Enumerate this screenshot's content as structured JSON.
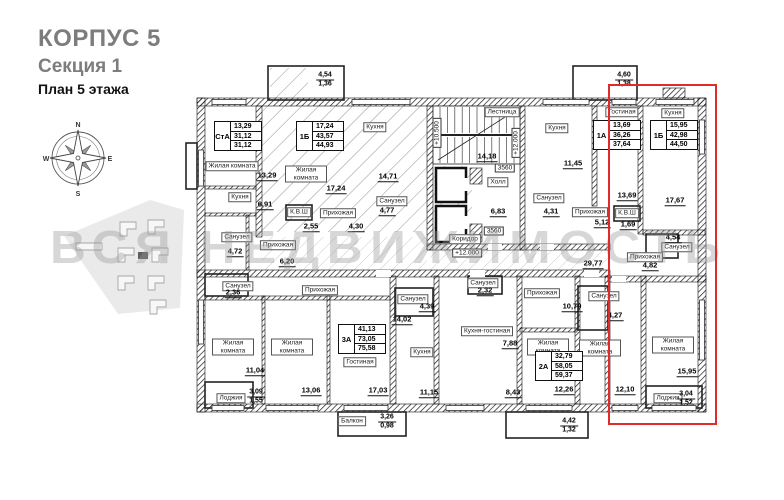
{
  "header": {
    "building": "КОРПУС 5",
    "section": "Секция 1",
    "floor_plan": "План 5 этажа"
  },
  "compass": {
    "north": "N",
    "east": "E",
    "south": "S",
    "west": "W"
  },
  "watermark": {
    "text": "ВСЯ НЕДВИЖИМОСТЬ"
  },
  "highlight": {
    "color": "#e02b2b"
  },
  "plan": {
    "apartment_tags": [
      {
        "type": "СтА",
        "living_area": "13,29",
        "area": "31,12",
        "total_area": "31,12",
        "x": 214,
        "y": 121
      },
      {
        "type": "1Б",
        "living_area": "17,24",
        "area": "43,57",
        "total_area": "44,93",
        "x": 296,
        "y": 121
      },
      {
        "type": "1А",
        "living_area": "13,69",
        "area": "36,26",
        "total_area": "37,64",
        "x": 593,
        "y": 120
      },
      {
        "type": "1Б",
        "living_area": "15,95",
        "area": "42,98",
        "total_area": "44,50",
        "x": 650,
        "y": 120
      },
      {
        "type": "3А",
        "living_area": "41,13",
        "area": "73,05",
        "total_area": "75,58",
        "x": 338,
        "y": 324
      },
      {
        "type": "2А",
        "living_area": "32,79",
        "area": "58,05",
        "total_area": "59,37",
        "x": 535,
        "y": 351
      }
    ],
    "room_labels": [
      {
        "t": "Жилая комната",
        "x": 232,
        "y": 166
      },
      {
        "t": "Кухня",
        "x": 240,
        "y": 197
      },
      {
        "t": "Санузел",
        "x": 237,
        "y": 237
      },
      {
        "t": "Прихожая",
        "x": 278,
        "y": 245
      },
      {
        "t": "Жилая комната",
        "x": 306,
        "y": 174,
        "w": 1
      },
      {
        "t": "Кухня",
        "x": 375,
        "y": 127
      },
      {
        "t": "Санузел",
        "x": 392,
        "y": 201
      },
      {
        "t": "К.В.Ш",
        "x": 299,
        "y": 212
      },
      {
        "t": "Прихожая",
        "x": 338,
        "y": 213
      },
      {
        "t": "Лестница",
        "x": 502,
        "y": 112
      },
      {
        "t": "Холл",
        "x": 498,
        "y": 182
      },
      {
        "t": "Кухня",
        "x": 557,
        "y": 128
      },
      {
        "t": "Санузел",
        "x": 549,
        "y": 198
      },
      {
        "t": "Прихожая",
        "x": 590,
        "y": 212
      },
      {
        "t": "Гостиная",
        "x": 622,
        "y": 112
      },
      {
        "t": "Кухня",
        "x": 673,
        "y": 113
      },
      {
        "t": "К.В.Ш",
        "x": 627,
        "y": 213
      },
      {
        "t": "Санузел",
        "x": 677,
        "y": 247
      },
      {
        "t": "Прихожая",
        "x": 645,
        "y": 257
      },
      {
        "t": "Коридор",
        "x": 465,
        "y": 239
      },
      {
        "t": "Санузел",
        "x": 238,
        "y": 286
      },
      {
        "t": "Прихожая",
        "x": 320,
        "y": 290
      },
      {
        "t": "Жилая комната",
        "x": 233,
        "y": 347,
        "w": 1
      },
      {
        "t": "Жилая комната",
        "x": 292,
        "y": 347,
        "w": 1
      },
      {
        "t": "Гостиная",
        "x": 360,
        "y": 362
      },
      {
        "t": "Кухня",
        "x": 422,
        "y": 352
      },
      {
        "t": "Санузел",
        "x": 413,
        "y": 299
      },
      {
        "t": "Санузел",
        "x": 483,
        "y": 283
      },
      {
        "t": "Прихожая",
        "x": 542,
        "y": 293
      },
      {
        "t": "Кухня-гостиная",
        "x": 487,
        "y": 331
      },
      {
        "t": "Жилая комната",
        "x": 548,
        "y": 347,
        "w": 1
      },
      {
        "t": "Санузел",
        "x": 604,
        "y": 296
      },
      {
        "t": "Жилая комната",
        "x": 600,
        "y": 348,
        "w": 1
      },
      {
        "t": "Жилая комната",
        "x": 673,
        "y": 345,
        "w": 1
      },
      {
        "t": "Лоджия",
        "x": 231,
        "y": 398
      },
      {
        "t": "Балкон",
        "x": 352,
        "y": 421
      },
      {
        "t": "Лоджия",
        "x": 668,
        "y": 398
      }
    ],
    "area_values": [
      {
        "t": "13,29",
        "x": 267,
        "y": 176
      },
      {
        "t": "6,91",
        "x": 265,
        "y": 205
      },
      {
        "t": "4,72",
        "x": 235,
        "y": 252
      },
      {
        "t": "6,20",
        "x": 287,
        "y": 262
      },
      {
        "t": "17,24",
        "x": 336,
        "y": 189
      },
      {
        "t": "14,71",
        "x": 388,
        "y": 177
      },
      {
        "t": "4,77",
        "x": 387,
        "y": 211
      },
      {
        "t": "2,55",
        "x": 311,
        "y": 227
      },
      {
        "t": "4,30",
        "x": 356,
        "y": 227
      },
      {
        "t": "14,18",
        "x": 487,
        "y": 157
      },
      {
        "t": "6,83",
        "x": 498,
        "y": 212
      },
      {
        "t": "11,45",
        "x": 573,
        "y": 164
      },
      {
        "t": "4,31",
        "x": 551,
        "y": 212
      },
      {
        "t": "5,12",
        "x": 602,
        "y": 223
      },
      {
        "t": "13,69",
        "x": 627,
        "y": 196
      },
      {
        "t": "1,69",
        "x": 628,
        "y": 225
      },
      {
        "t": "17,67",
        "x": 675,
        "y": 201
      },
      {
        "t": "4,54",
        "x": 673,
        "y": 238
      },
      {
        "t": "4,82",
        "x": 650,
        "y": 266
      },
      {
        "t": "29,77",
        "x": 593,
        "y": 264
      },
      {
        "t": "2,36",
        "x": 233,
        "y": 293
      },
      {
        "t": "11,04",
        "x": 255,
        "y": 371
      },
      {
        "t": "13,06",
        "x": 311,
        "y": 391
      },
      {
        "t": "17,03",
        "x": 378,
        "y": 391
      },
      {
        "t": "14,02",
        "x": 402,
        "y": 320
      },
      {
        "t": "4,39",
        "x": 427,
        "y": 307
      },
      {
        "t": "11,15",
        "x": 429,
        "y": 393
      },
      {
        "t": "2,32",
        "x": 485,
        "y": 291
      },
      {
        "t": "7,88",
        "x": 510,
        "y": 344
      },
      {
        "t": "8,43",
        "x": 513,
        "y": 393
      },
      {
        "t": "10,79",
        "x": 572,
        "y": 307
      },
      {
        "t": "12,26",
        "x": 564,
        "y": 390
      },
      {
        "t": "4,27",
        "x": 615,
        "y": 316
      },
      {
        "t": "12,10",
        "x": 625,
        "y": 390
      },
      {
        "t": "15,95",
        "x": 687,
        "y": 372
      }
    ],
    "stacked_values": [
      {
        "top": "4,54",
        "bottom": "1,36",
        "x": 325,
        "y": 80
      },
      {
        "top": "4,60",
        "bottom": "1,38",
        "x": 624,
        "y": 80
      },
      {
        "top": "3,09",
        "bottom": "1,55",
        "x": 256,
        "y": 397
      },
      {
        "top": "3,26",
        "bottom": "0,98",
        "x": 387,
        "y": 422
      },
      {
        "top": "4,42",
        "bottom": "1,32",
        "x": 569,
        "y": 426
      },
      {
        "top": "3,04",
        "bottom": "1,52",
        "x": 686,
        "y": 399
      }
    ],
    "notes": [
      {
        "t": "+10.500",
        "x": 437,
        "y": 133,
        "rot": 1
      },
      {
        "t": "+12.000",
        "x": 516,
        "y": 143,
        "rot": 1
      },
      {
        "t": "+12.000",
        "x": 467,
        "y": 253
      },
      {
        "t": "3560",
        "x": 505,
        "y": 168
      },
      {
        "t": "3560",
        "x": 494,
        "y": 231
      }
    ]
  }
}
